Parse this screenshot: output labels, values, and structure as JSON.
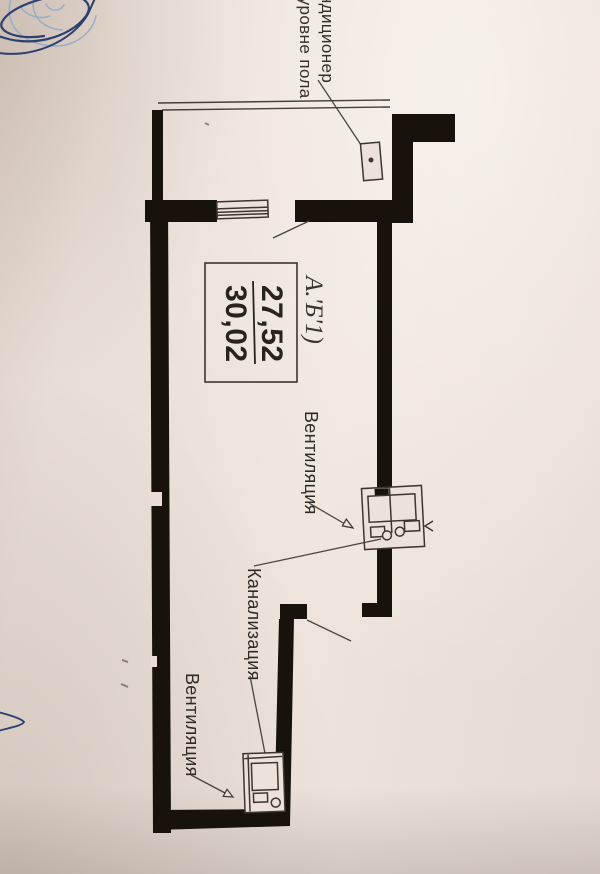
{
  "document": {
    "kind": "photographed floor plan sketch",
    "colors": {
      "paper": "#e9ded6",
      "wall": "#18120d",
      "ink": "#46403a",
      "text": "#2e2a26",
      "pen_dark": "#2b4070",
      "pen_light": "#8fa9c8"
    },
    "ac_label": {
      "line1": "кондиционер",
      "line2": "на уровне пола"
    },
    "room_label": {
      "designation": "А.'Б'1)",
      "area_upper": "27,52",
      "area_lower": "30,02"
    },
    "annotations": {
      "ventilation_mid": "Вентиляция",
      "sewer": "Канализация",
      "ventilation_bottom": "Вентиляция"
    }
  }
}
